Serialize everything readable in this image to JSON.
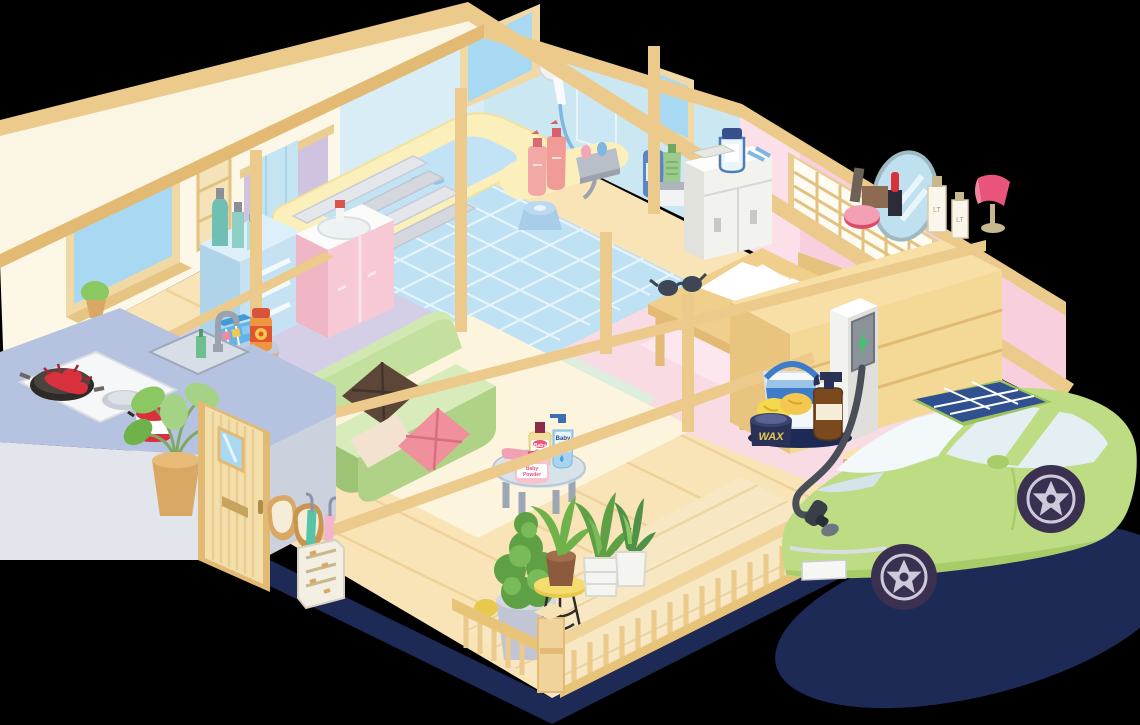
{
  "labels": {
    "baby_oil_1": "Baby",
    "baby_oil_2": "OIL",
    "baby_lotion": "Baby",
    "baby_powder_1": "Baby",
    "baby_powder_2": "Powder",
    "wax": "WAX"
  },
  "colors": {
    "background": "#000000",
    "foundation_navy": "#1D2A56",
    "beam_wood": "#EBCA8C",
    "beam_wood_dark": "#E2BA74",
    "floor_wood": "#F8E4B6",
    "floor_wood_line": "#EDD092",
    "wall_cream": "#FCF7E6",
    "wall_bath_blue": "#D8EDF5",
    "wall_bath_blue_dark": "#CBE7F1",
    "wall_pink": "#F8CFDC",
    "floor_tile_blue": "#BFE1F4",
    "floor_washroom_purple": "#D4CFE6",
    "floor_laundry_green": "#DDEEDF",
    "floor_bedroom_pink": "#F8DBE3",
    "floor_living_cream": "#FCF4DC",
    "porch_deck": "#F7E7C3",
    "sofa_green": "#C3E09E",
    "car_green": "#BDDC84",
    "solar_navy": "#31508F",
    "charger_gray": "#F2F2EF",
    "window_blue": "#A9D9F2",
    "tub_yellow": "#FBF0BC",
    "water_blue": "#C2E2F6",
    "counter_top_blue": "#B5C3E0",
    "counter_face_gray": "#E2E5EB"
  },
  "inventory": {
    "bathroom": [
      "bathtub",
      "bath-water",
      "bath-lid-boards",
      "shower-head",
      "wall-mirror",
      "shampoo-bottles",
      "faucet",
      "bath-stool",
      "soap-bottles",
      "tiled-floor",
      "bath-windows"
    ],
    "washroom": [
      "vanity-sink",
      "drawer-cabinet",
      "cosmetic-bottles",
      "hand-towel",
      "wall-niche"
    ],
    "laundry": [
      "medicine-cabinet",
      "storage-jar",
      "small-box"
    ],
    "bedroom": [
      "shoji-window",
      "dresser",
      "oval-mirror",
      "cosmetics",
      "blush-compact",
      "lipstick",
      "table-lamp",
      "desk",
      "papers",
      "sunglasses",
      "chair",
      "timber-brace"
    ],
    "kitchen": [
      "l-shaped-counter",
      "cooktop",
      "pan-with-crayfish",
      "burner",
      "red-pot",
      "sink",
      "faucet",
      "soap-bottle",
      "potted-plant",
      "side-table",
      "pill-case",
      "supplement-bottle"
    ],
    "entrance": [
      "wooden-door",
      "door-window",
      "slippers",
      "umbrella-stand",
      "green-umbrella",
      "pink-umbrella"
    ],
    "living": [
      "green-sofa",
      "brown-cushion",
      "beige-cushion",
      "pink-cushion",
      "glass-table",
      "baby-lotion-bottle",
      "baby-oil-bottle",
      "baby-powder-box",
      "powder-puff"
    ],
    "porch": [
      "wood-deck",
      "railing",
      "corner-newel",
      "topiary",
      "plant-stand",
      "potted-plants",
      "white-planters",
      "wash-bucket",
      "wax-can",
      "sponges",
      "spray-bottle",
      "detergent-jug"
    ],
    "exterior": [
      "ev-charger-station",
      "charger-panel",
      "charging-bolt-icon",
      "charging-cable",
      "charging-connector",
      "electric-car",
      "solar-panel-roof",
      "windshield",
      "side-windows",
      "wheels",
      "license-plate",
      "car-shadow",
      "house-foundation-shadow"
    ]
  }
}
